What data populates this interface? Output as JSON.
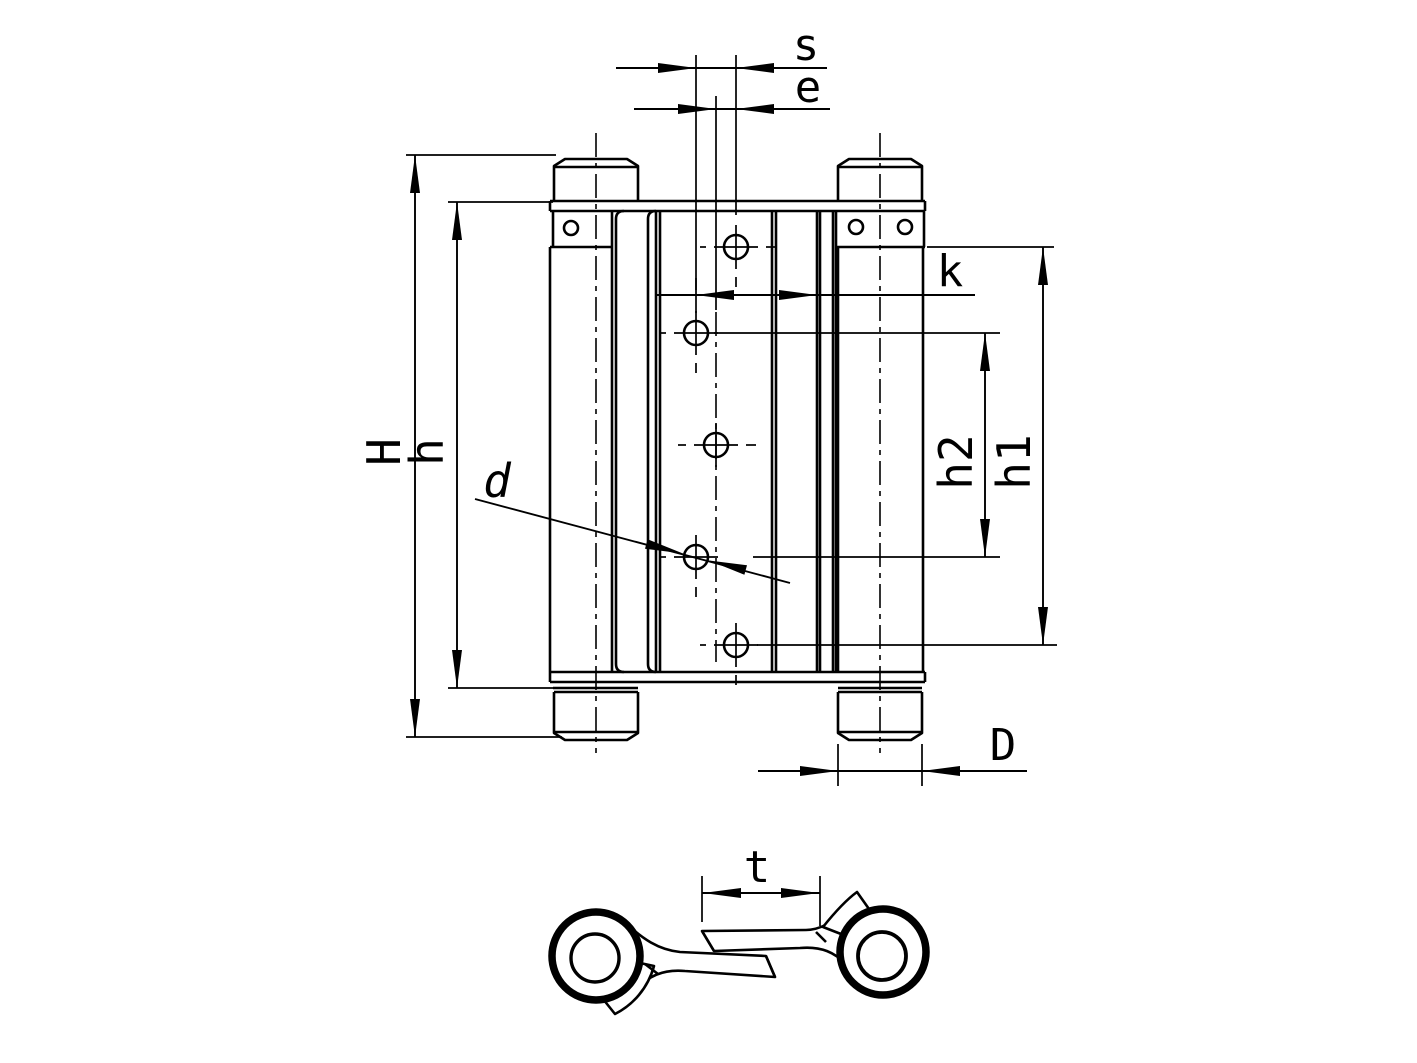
{
  "page": {
    "background_color": "#ffffff",
    "line_color": "#000000"
  },
  "drawing": {
    "views": {
      "front_view": "hinge front elevation",
      "section_view": "leaf cross-section"
    }
  },
  "dimensions": {
    "s": "s",
    "e": "e",
    "H": "H",
    "h": "h",
    "k": "k",
    "h1": "h1",
    "h2": "h2",
    "d": "d",
    "D": "D",
    "t": "t"
  }
}
